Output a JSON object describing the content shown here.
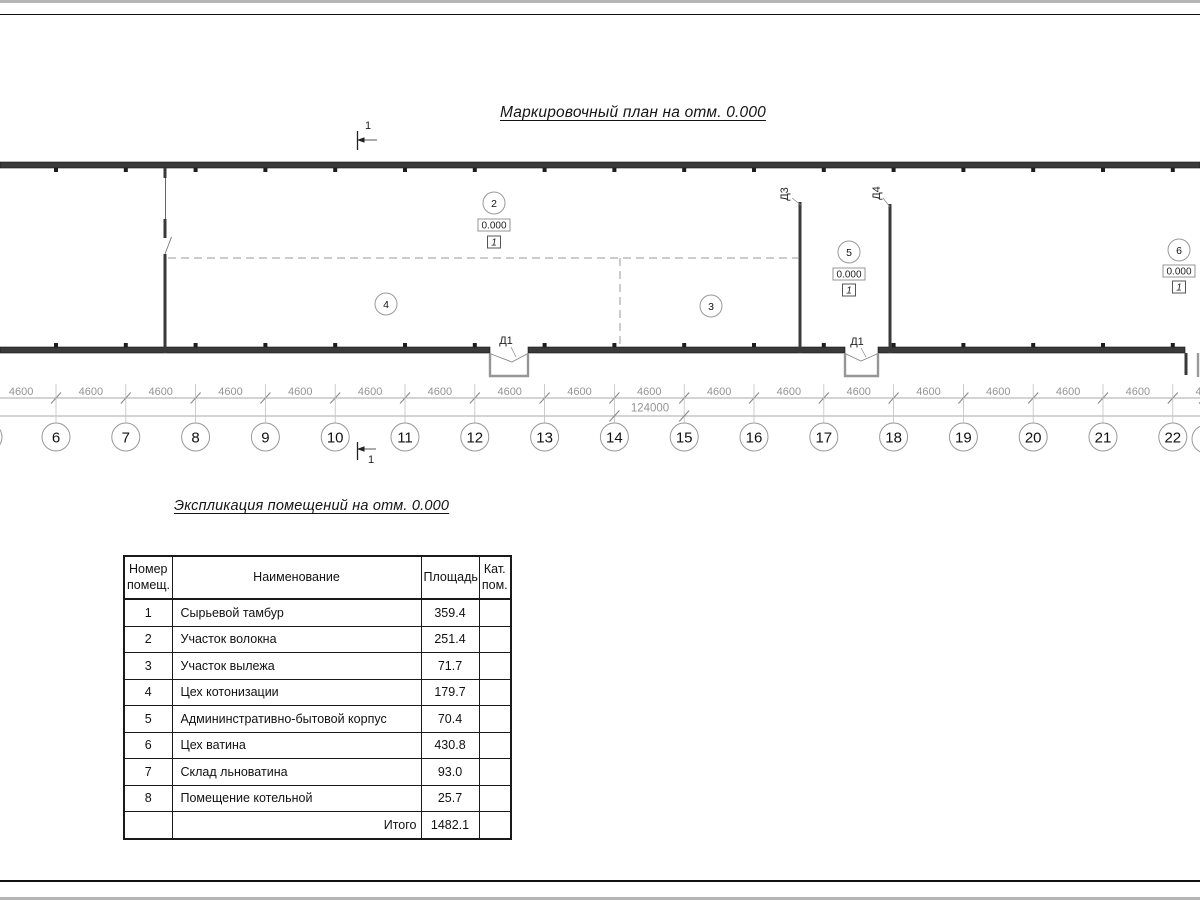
{
  "page": {
    "title": "Маркировочный план на отм. 0.000",
    "table_title": "Экспликация помещений на отм. 0.000"
  },
  "section_marks": {
    "label": "1"
  },
  "plan": {
    "room_markers": [
      {
        "number": "2",
        "elevation": "0.000",
        "category": "1"
      },
      {
        "number": "4",
        "elevation": "",
        "category": ""
      },
      {
        "number": "3",
        "elevation": "",
        "category": ""
      },
      {
        "number": "5",
        "elevation": "0.000",
        "category": "1"
      },
      {
        "number": "6",
        "elevation": "0.000",
        "category": "1"
      }
    ],
    "door_labels": {
      "d1": "Д1",
      "d3": "Д3",
      "d4": "Д4"
    }
  },
  "dimensions": {
    "bay_labels": [
      "4600",
      "4600",
      "4600",
      "4600",
      "4600",
      "4600",
      "4600",
      "4600",
      "4600",
      "4600",
      "4600",
      "4600",
      "4600",
      "4600",
      "4600",
      "4600",
      "4600",
      "4600"
    ],
    "total_label": "124000"
  },
  "grid_axes": [
    "6",
    "7",
    "8",
    "9",
    "10",
    "11",
    "12",
    "13",
    "14",
    "15",
    "16",
    "17",
    "18",
    "19",
    "20",
    "21",
    "22"
  ],
  "schedule": {
    "headers": [
      "Номер\nпомещ.",
      "Наименование",
      "Площадь",
      "Кат.\nпом."
    ],
    "rows": [
      {
        "num": "1",
        "name": "Сырьевой тамбур",
        "area": "359.4",
        "cat": ""
      },
      {
        "num": "2",
        "name": "Участок волокна",
        "area": "251.4",
        "cat": ""
      },
      {
        "num": "3",
        "name": "Участок вылежа",
        "area": "71.7",
        "cat": ""
      },
      {
        "num": "4",
        "name": "Цех котонизации",
        "area": "179.7",
        "cat": ""
      },
      {
        "num": "5",
        "name": "Админинстративно-бытовой корпус",
        "area": "70.4",
        "cat": ""
      },
      {
        "num": "6",
        "name": "Цех ватина",
        "area": "430.8",
        "cat": ""
      },
      {
        "num": "7",
        "name": "Склад льноватина",
        "area": "93.0",
        "cat": ""
      },
      {
        "num": "8",
        "name": "Помещение котельной",
        "area": "25.7",
        "cat": ""
      }
    ],
    "total": {
      "label": "Итого",
      "area": "1482.1"
    }
  }
}
